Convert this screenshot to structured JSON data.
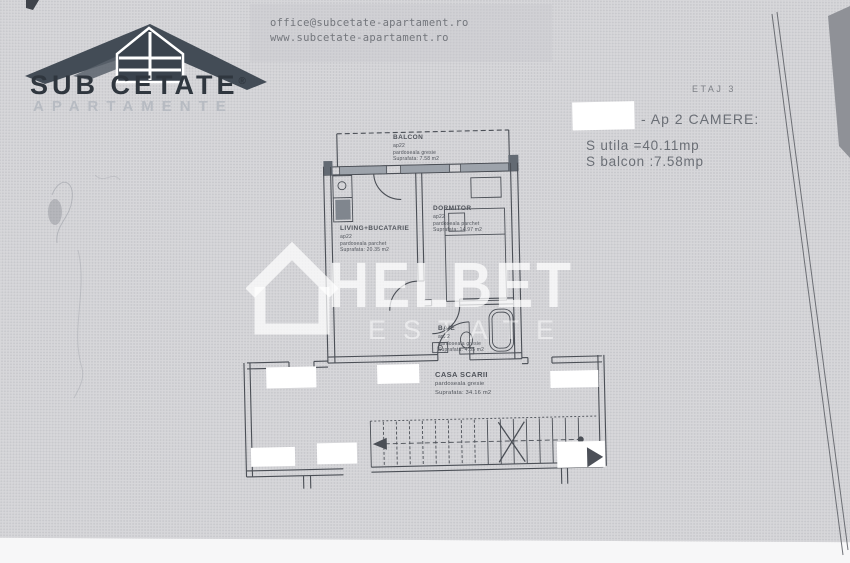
{
  "brand": {
    "name": "SUB CETATE",
    "registered": "®",
    "tagline": "APARTAMENTE"
  },
  "contact": {
    "email": "office@subcetate-apartament.ro",
    "website": "www.subcetate-apartament.ro"
  },
  "header": {
    "floor_label": "ETAJ 3",
    "apartment_label": "- Ap 2 CAMERE:",
    "usable_area": "S utila =40.11mp",
    "balcony_area": "S balcon :7.58mp"
  },
  "watermark": {
    "brand": "HELBET",
    "sub": "ESTATE"
  },
  "rooms": {
    "balcon": {
      "name": "BALCON",
      "unit": "ap22",
      "flooring": "pardoseala gresie",
      "area": "Suprafata: 7.58 m2"
    },
    "living": {
      "name": "LIVING+BUCATARIE",
      "unit": "ap22",
      "flooring": "pardoseala parchet",
      "area": "Suprafata: 20.35 m2"
    },
    "dormitor": {
      "name": "DORMITOR",
      "unit": "ap22",
      "flooring": "pardoseala parchet",
      "area": "Suprafata: 14.97 m2"
    },
    "baie": {
      "name": "BAIE",
      "unit": "ap22",
      "flooring": "pardoseala gresie",
      "area": "Suprafata: 4.85 m2"
    },
    "casa_scarii": {
      "name": "CASA SCARII",
      "flooring": "pardoseala gresie",
      "area": "Suprafata: 34.16 m2"
    }
  },
  "colors": {
    "page_background": "#d7d7da",
    "plan_line": "#4b4f56",
    "logo_dark": "#3d4751",
    "text_gray": "#6b6f76",
    "watermark_white": "#ffffff",
    "window_fill": "#9da3ab"
  }
}
